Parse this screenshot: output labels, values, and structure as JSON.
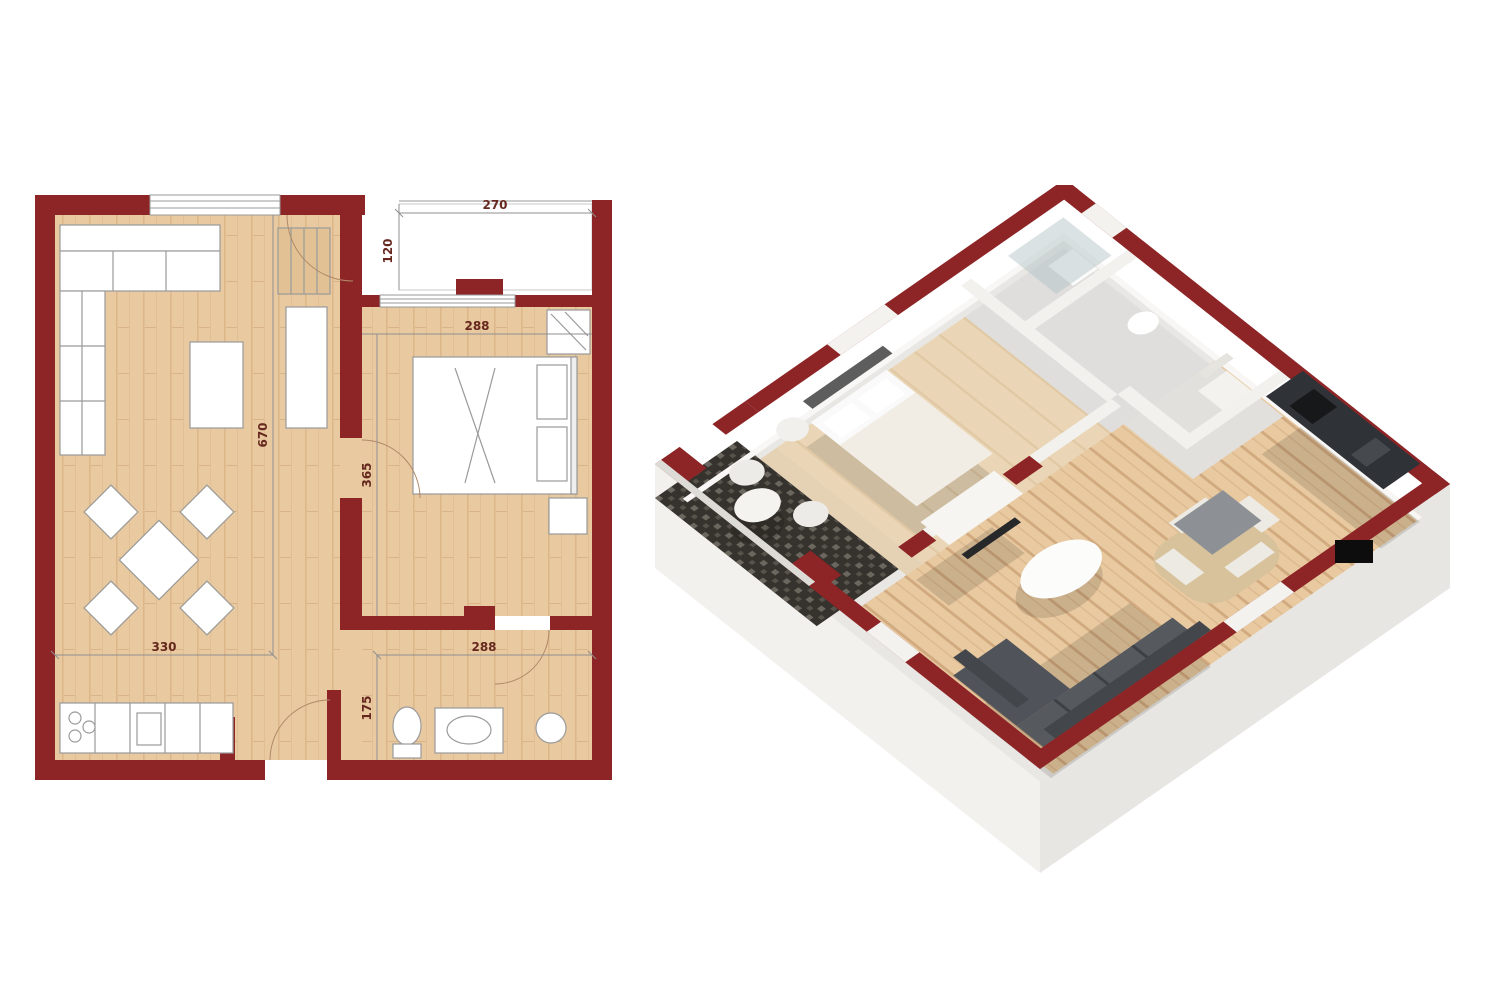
{
  "plan2d": {
    "dims": {
      "d270": "270",
      "d120": "120",
      "d288_bedroom": "288",
      "d365": "365",
      "d670": "670",
      "d330": "330",
      "d288_bath": "288",
      "d175": "175"
    }
  },
  "colors": {
    "wall": "#8d2426",
    "wood": "#e8c9a0",
    "wood_light": "#ead6b6",
    "balcony_floor": "#36332e",
    "sofa": "#565a5f",
    "sofa_back": "#43474b",
    "counter_top": "#2f3237",
    "dim_text": "#66281e",
    "redaction": "#0d0d0d",
    "outer_wall_face": "#f2f1ee",
    "outer_wall_face_dark": "#e7e6e2"
  }
}
